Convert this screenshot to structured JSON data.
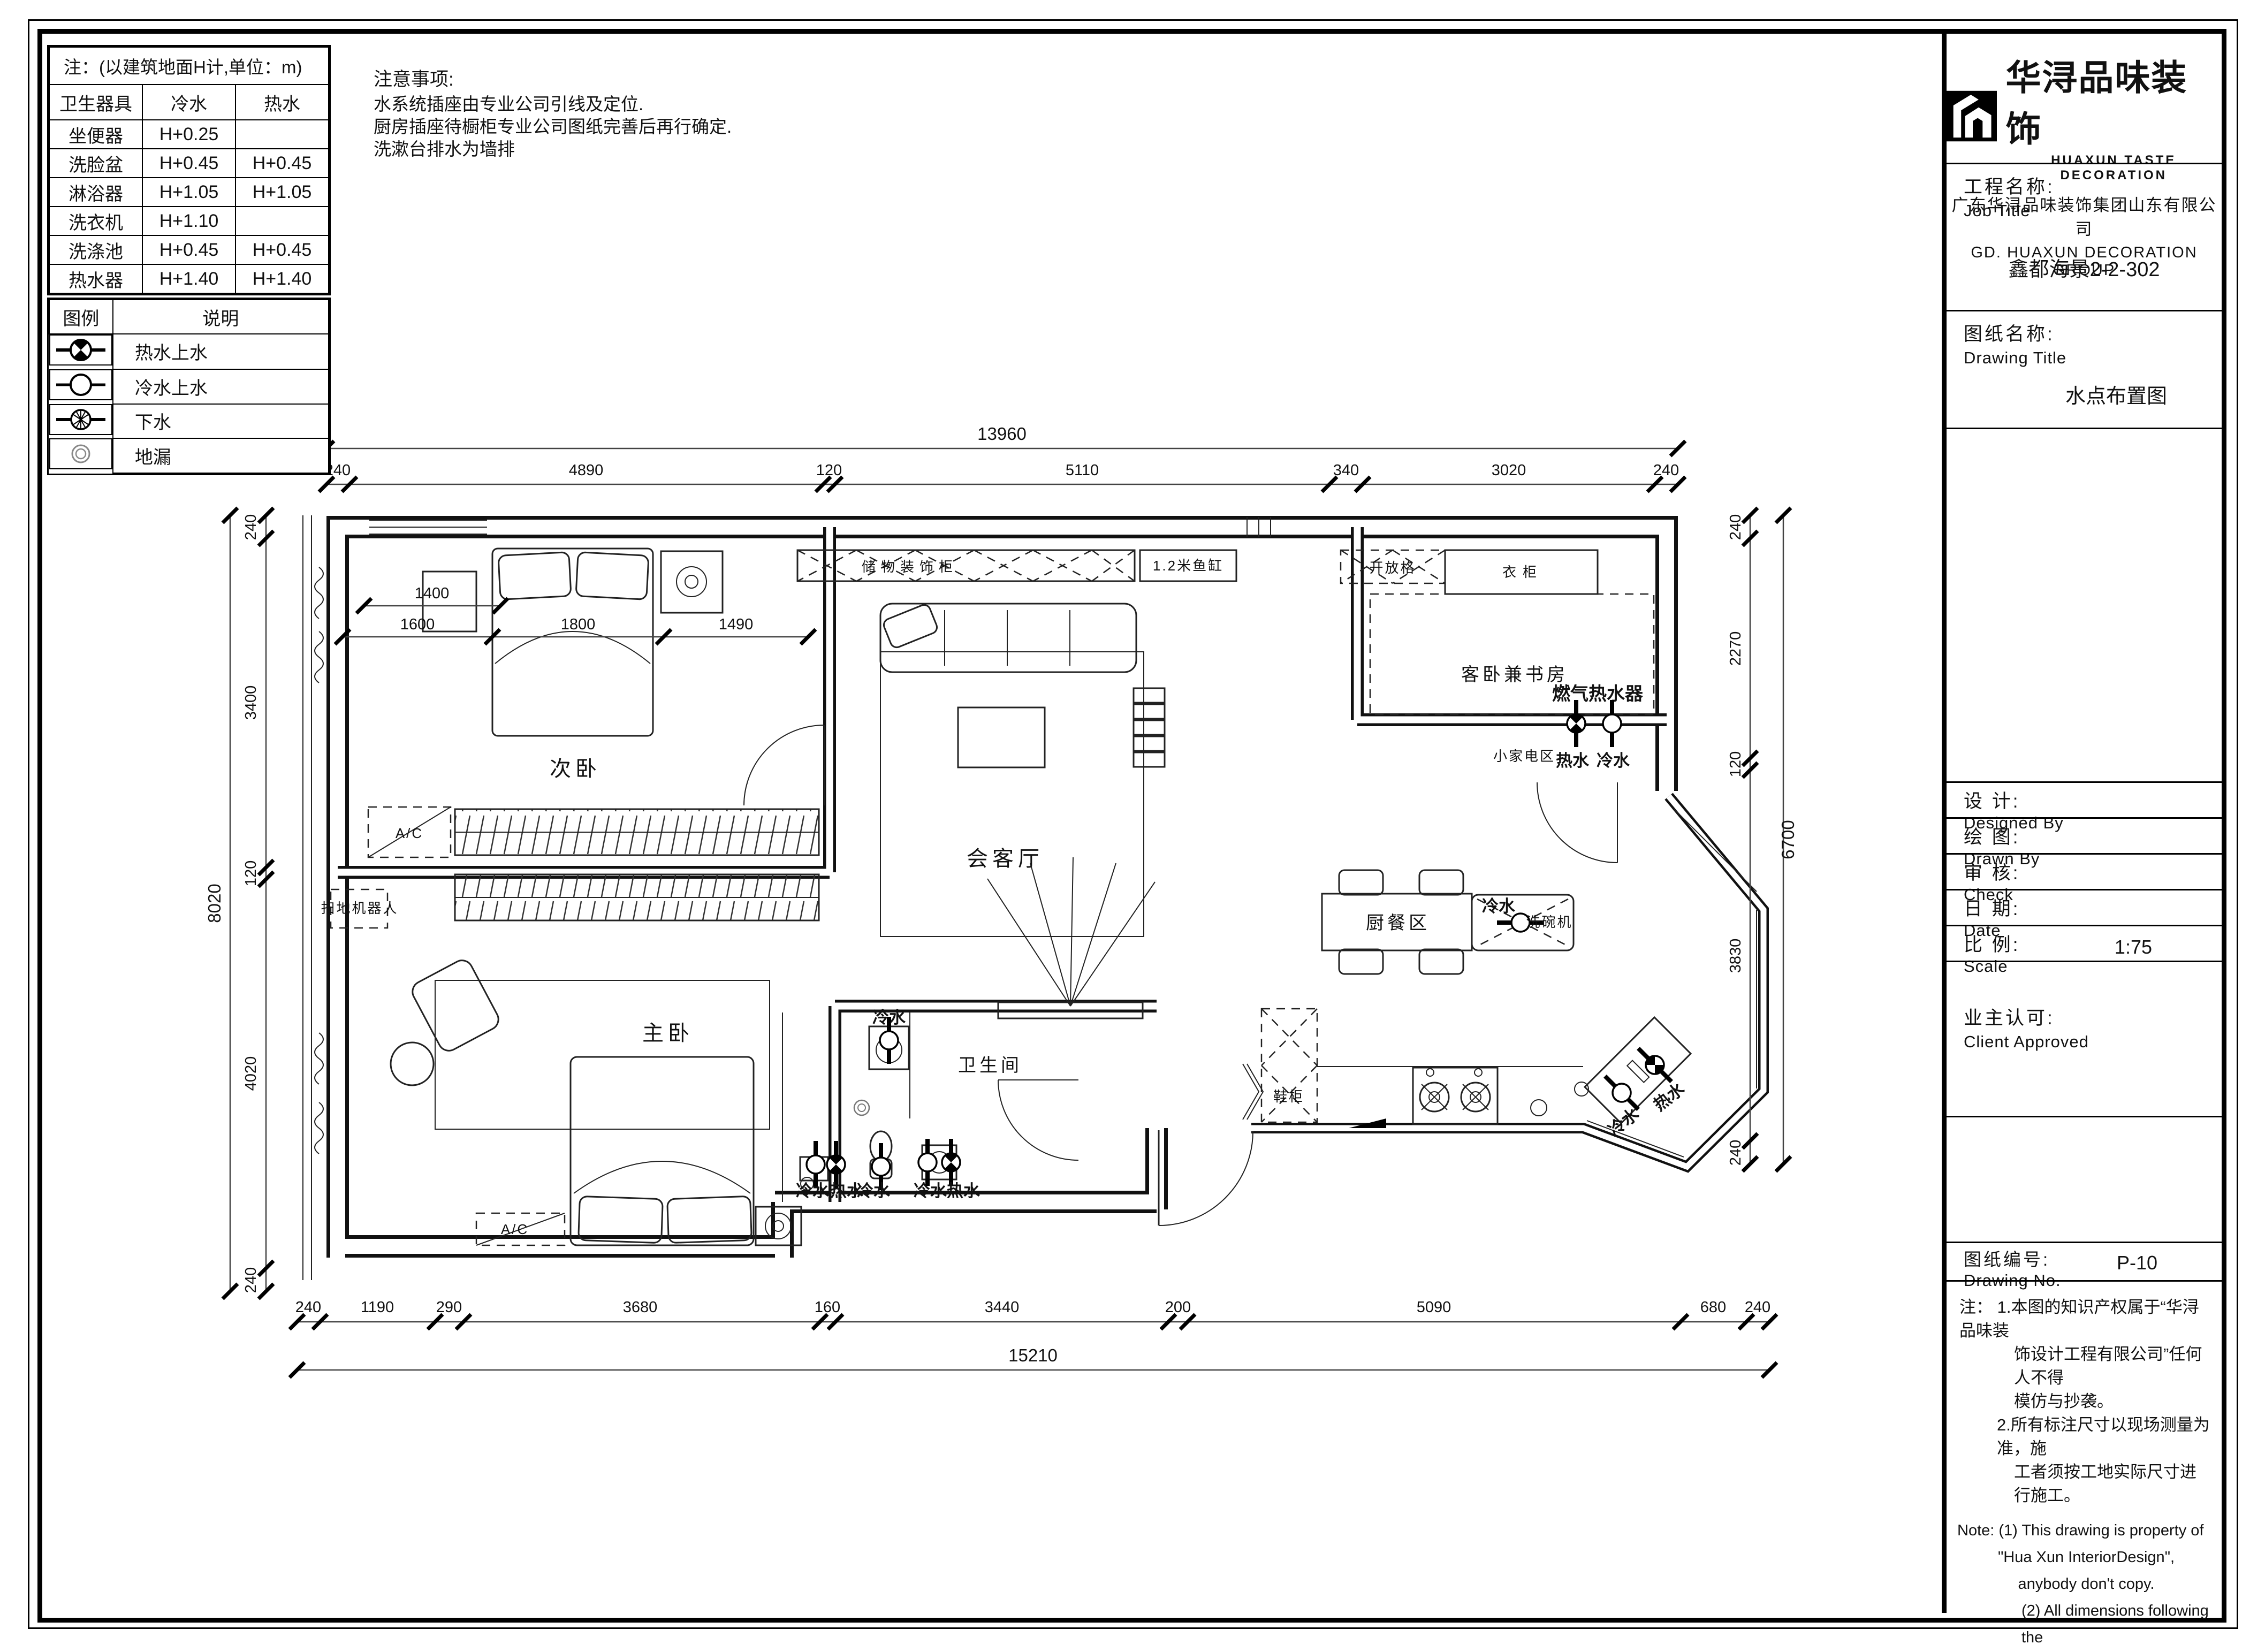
{
  "fixture_table": {
    "title": "注：(以建筑地面H计,单位：m)",
    "headers": [
      "卫生器具",
      "冷水",
      "热水"
    ],
    "rows": [
      [
        "坐便器",
        "H+0.25",
        ""
      ],
      [
        "洗脸盆",
        "H+0.45",
        "H+0.45"
      ],
      [
        "淋浴器",
        "H+1.05",
        "H+1.05"
      ],
      [
        "洗衣机",
        "H+1.10",
        ""
      ],
      [
        "洗涤池",
        "H+0.45",
        "H+0.45"
      ],
      [
        "热水器",
        "H+1.40",
        "H+1.40"
      ]
    ]
  },
  "legend": {
    "symbol_header": "图例",
    "desc_header": "说明",
    "items": [
      {
        "icon": "hot-water-symbol",
        "label": "热水上水"
      },
      {
        "icon": "cold-water-symbol",
        "label": "冷水上水"
      },
      {
        "icon": "drain-symbol",
        "label": "下水"
      },
      {
        "icon": "floor-drain-symbol",
        "label": "地漏"
      }
    ]
  },
  "site_notes": {
    "title": "注意事项:",
    "lines": [
      "水系统插座由专业公司引线及定位.",
      "厨房插座待橱柜专业公司图纸完善后再行确定.",
      "洗漱台排水为墙排"
    ]
  },
  "plan": {
    "rooms": {
      "bedroom2": "次卧",
      "living": "会客厅",
      "guest_study": "客卧兼书房",
      "kitchen_dining": "厨餐区",
      "master": "主卧",
      "bathroom": "卫生间"
    },
    "features": {
      "storage_cabinet": "储物装饰柜",
      "fish_tank": "1.2米鱼缸",
      "open_shelf": "开放格",
      "wardrobe": "衣柜",
      "gas_heater": "燃气热水器",
      "small_appliance": "小家电区",
      "dishwasher": "洗碗机",
      "shoe_cabinet": "鞋柜",
      "robot_vacuum": "扫地机器人",
      "ac": "A/C"
    },
    "water": {
      "hot": "热水",
      "cold": "冷水"
    },
    "inner_dims": {
      "d1400": "1400",
      "d1600": "1600",
      "d1800": "1800",
      "d1490": "1490"
    }
  },
  "dims": {
    "top": {
      "total": "13960",
      "segments": [
        "240",
        "4890",
        "120",
        "5110",
        "340",
        "3020",
        "240"
      ]
    },
    "bottom": {
      "total": "15210",
      "segments": [
        "240",
        "1190",
        "290",
        "3680",
        "160",
        "3440",
        "200",
        "5090",
        "680",
        "240"
      ]
    },
    "left": {
      "total": "8020",
      "segments": [
        "240",
        "3400",
        "120",
        "4020",
        "240"
      ]
    },
    "right": {
      "outer": "6700",
      "segments": [
        "240",
        "2270",
        "120",
        "3830",
        "240"
      ]
    }
  },
  "title_block": {
    "brand_cn": "华浔品味装饰",
    "brand_en": "HUAXUN TASTE DECORATION",
    "company_cn": "广东华浔品味装饰集团山东有限公司",
    "company_en": "GD.  HUAXUN   DECORATION   GROUP",
    "job_label_cn": "工程名称:",
    "job_label_en": "Job Title",
    "job_value": "鑫都海景2-2-302",
    "drawing_label_cn": "图纸名称:",
    "drawing_label_en": "Drawing Title",
    "drawing_value": "水点布置图",
    "designed_cn": "设  计:",
    "designed_en": "Designed By",
    "drawn_cn": "绘  图:",
    "drawn_en": "Drawn By",
    "check_cn": "审  核:",
    "check_en": "Check",
    "date_cn": "日  期:",
    "date_en": "Date",
    "scale_cn": "比  例:",
    "scale_en": "Scale",
    "scale_value": "1:75",
    "client_cn": "业主认可:",
    "client_en": "Client Approved",
    "no_cn": "图纸编号:",
    "no_en": "Drawing No.",
    "no_value": "P-10",
    "notes_cn_0": "注： 1.本图的知识产权属于“华浔品味装",
    "notes_cn_1": "饰设计工程有限公司”任何人不得",
    "notes_cn_2": "模仿与抄袭。",
    "notes_cn_3": "2.所有标注尺寸以现场测量为准，施",
    "notes_cn_4": "工者须按工地实际尺寸进行施工。",
    "notes_en_0": "Note:  (1) This drawing is property of",
    "notes_en_1": "\"Hua Xun InteriorDesign\",",
    "notes_en_2": "anybody don't copy.",
    "notes_en_3": "(2) All dimensions following the",
    "notes_en_4": "site,contractor must be check",
    "notes_en_5": "the mersu-rement."
  }
}
